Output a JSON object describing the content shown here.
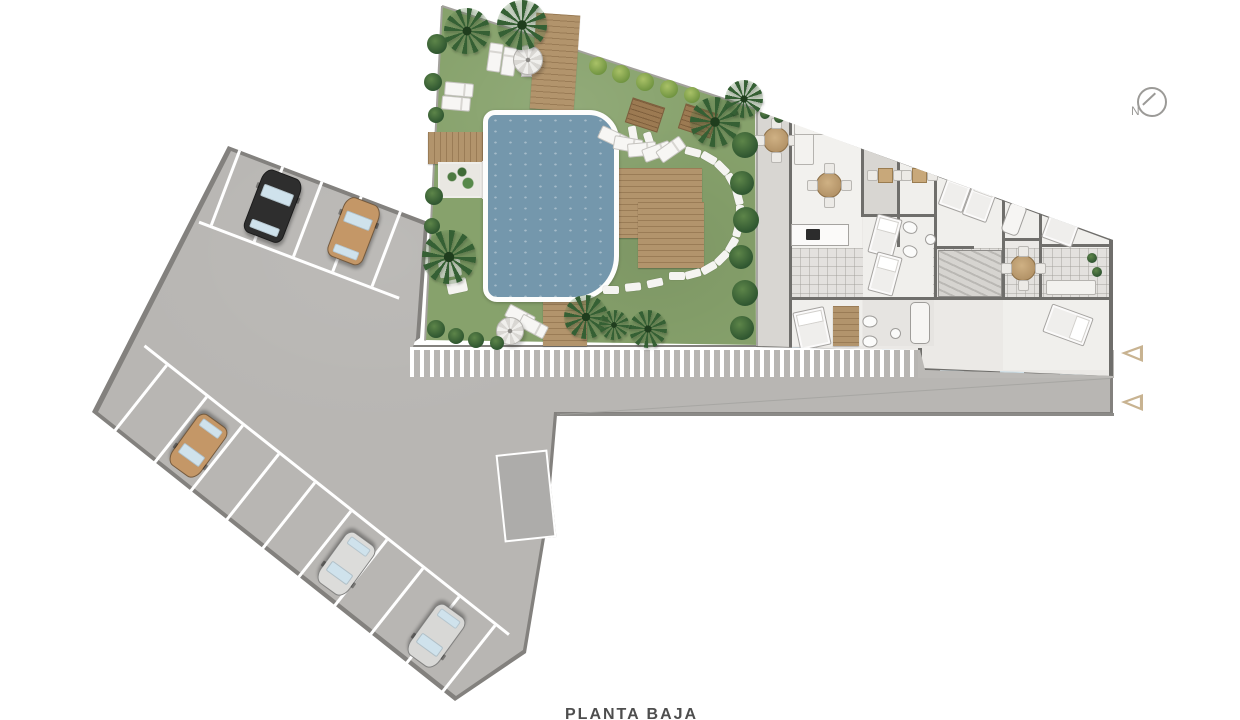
{
  "meta": {
    "caption": "PLANTA BAJA",
    "north_label": "N"
  },
  "colors": {
    "lot": "#b8b6b3",
    "lot_edge": "#83817e",
    "grass": "#87a26c",
    "pool": "#7497ac",
    "wood": "#b2946c",
    "wall": "#6f6e6b",
    "arrow_outline": "#c8b391",
    "car_black": "#2e2e2e",
    "car_tan": "#c49767",
    "car_silver": "#dcdcda"
  },
  "lot": {
    "outer": [
      [
        228,
        146
      ],
      [
        428,
        222
      ],
      [
        420,
        338
      ],
      [
        410,
        345
      ],
      [
        1113,
        345
      ],
      [
        1113,
        415
      ],
      [
        557,
        415
      ],
      [
        548,
        520
      ],
      [
        526,
        653
      ],
      [
        455,
        701
      ],
      [
        92,
        412
      ]
    ],
    "inner": [
      [
        231,
        151
      ],
      [
        424,
        225
      ],
      [
        416,
        338
      ],
      [
        413,
        347
      ],
      [
        1110,
        347
      ],
      [
        1110,
        412
      ],
      [
        554,
        412
      ],
      [
        545,
        519
      ],
      [
        523,
        650
      ],
      [
        456,
        696
      ],
      [
        98,
        412
      ]
    ]
  },
  "stall_rows": [
    {
      "x": 228,
      "y": 146,
      "w": 214,
      "h": 80,
      "rot": 20.8,
      "origin": "0px 0px",
      "period": 42,
      "offset": 18,
      "aisle": "bottom"
    },
    {
      "x": 92,
      "y": 326,
      "w": 465,
      "h": 86,
      "rot": 38.4,
      "origin": "0px 86px",
      "period": 46,
      "offset": 36,
      "aisle": "top"
    }
  ],
  "ramp": {
    "x": 500,
    "y": 452,
    "w": 48,
    "h": 84,
    "rot": -6
  },
  "cars": [
    {
      "color": "#2e2e2e",
      "x": 252,
      "y": 172,
      "w": 40,
      "h": 66,
      "rot": 21
    },
    {
      "color": "#c49767",
      "x": 335,
      "y": 199,
      "w": 36,
      "h": 62,
      "rot": 21
    },
    {
      "color": "#c49767",
      "x": 180,
      "y": 415,
      "w": 34,
      "h": 60,
      "rot": 216
    },
    {
      "color": "#dcdcda",
      "x": 328,
      "y": 533,
      "w": 34,
      "h": 60,
      "rot": 216
    },
    {
      "color": "#d8d8d6",
      "x": 418,
      "y": 605,
      "w": 34,
      "h": 60,
      "rot": 216
    }
  ],
  "road": {
    "edge": {
      "x": 557,
      "y": 413,
      "w": 557,
      "h": 3
    },
    "joint": {
      "x": 560,
      "y": 414,
      "len": 552,
      "rot": -3.75
    }
  },
  "crosswalk": {
    "x": 410,
    "y": 347,
    "w": 508,
    "h": 27
  },
  "sidewalk": {
    "x": 918,
    "y": 347,
    "w": 196,
    "h": 28
  },
  "garden": {
    "x": 425,
    "y": 4,
    "w": 336,
    "h": 344,
    "clip": [
      [
        17,
        2
      ],
      [
        334,
        106
      ],
      [
        334,
        341
      ],
      [
        0,
        336
      ]
    ],
    "edge_top": {
      "x": 442,
      "y": 5,
      "len": 333,
      "rot": 18.2
    },
    "edge_left": {
      "x": 441,
      "y": 6,
      "len": 335,
      "rot": 2.9
    },
    "decks": [
      {
        "x": 533,
        "y": 14,
        "w": 44,
        "h": 96,
        "rot": 4,
        "dir": "h"
      },
      {
        "x": 428,
        "y": 132,
        "w": 98,
        "h": 32,
        "rot": 0,
        "dir": "v"
      },
      {
        "x": 618,
        "y": 168,
        "w": 84,
        "h": 70,
        "rot": 0,
        "dir": "h"
      },
      {
        "x": 638,
        "y": 202,
        "w": 66,
        "h": 66,
        "rot": 0,
        "dir": "h"
      },
      {
        "x": 543,
        "y": 286,
        "w": 44,
        "h": 60,
        "rot": 0,
        "dir": "h"
      }
    ],
    "benches": [
      {
        "x": 628,
        "y": 102,
        "w": 32,
        "h": 24,
        "rot": 18
      },
      {
        "x": 681,
        "y": 108,
        "w": 32,
        "h": 24,
        "rot": 18
      }
    ],
    "planters": [
      {
        "x": 438,
        "y": 162,
        "w": 40,
        "h": 32,
        "kind": "g"
      },
      {
        "x": 482,
        "y": 161,
        "w": 24,
        "h": 34,
        "kind": "r"
      }
    ],
    "pool": {
      "x": 483,
      "y": 110,
      "w": 126,
      "h": 182,
      "radius": "12px 30px 46px 14px"
    },
    "parasols": [
      {
        "x": 513,
        "y": 45,
        "d": 28
      },
      {
        "x": 496,
        "y": 317,
        "d": 26
      }
    ],
    "loungers": [
      [
        494,
        56,
        8
      ],
      [
        508,
        60,
        8
      ],
      [
        458,
        88,
        95
      ],
      [
        455,
        102,
        95
      ],
      [
        612,
        136,
        115
      ],
      [
        627,
        143,
        100
      ],
      [
        641,
        148,
        85
      ],
      [
        656,
        150,
        70
      ],
      [
        670,
        148,
        55
      ],
      [
        519,
        315,
        118
      ],
      [
        532,
        325,
        118
      ]
    ],
    "side_tables": [
      [
        521,
        66
      ]
    ],
    "stones": [
      [
        633,
        134,
        80
      ],
      [
        649,
        140,
        72
      ],
      [
        693,
        152,
        15
      ],
      [
        709,
        158,
        30
      ],
      [
        722,
        168,
        45
      ],
      [
        732,
        181,
        60
      ],
      [
        738,
        197,
        75
      ],
      [
        740,
        213,
        90
      ],
      [
        738,
        229,
        105
      ],
      [
        732,
        245,
        120
      ],
      [
        722,
        258,
        135
      ],
      [
        709,
        268,
        150
      ],
      [
        693,
        274,
        165
      ],
      [
        677,
        276,
        0
      ],
      [
        655,
        283,
        168
      ],
      [
        633,
        287,
        174
      ],
      [
        611,
        290,
        0
      ]
    ],
    "pads": [
      [
        450,
        268,
        22,
        17,
        -8
      ],
      [
        457,
        286,
        20,
        14,
        -12
      ]
    ],
    "palms": [
      [
        467,
        31,
        46
      ],
      [
        522,
        25,
        50
      ],
      [
        449,
        257,
        54
      ],
      [
        715,
        122,
        50
      ],
      [
        744,
        99,
        38
      ],
      [
        586,
        317,
        44
      ],
      [
        648,
        329,
        38
      ],
      [
        614,
        325,
        30
      ]
    ],
    "bushes_dark": [
      [
        745,
        145,
        26
      ],
      [
        742,
        183,
        24
      ],
      [
        746,
        220,
        26
      ],
      [
        741,
        257,
        24
      ],
      [
        745,
        293,
        26
      ],
      [
        742,
        328,
        24
      ],
      [
        437,
        44,
        20
      ],
      [
        433,
        82,
        18
      ],
      [
        436,
        115,
        16
      ],
      [
        434,
        196,
        18
      ],
      [
        432,
        226,
        16
      ],
      [
        436,
        329,
        18
      ],
      [
        456,
        336,
        16
      ],
      [
        476,
        340,
        16
      ],
      [
        497,
        343,
        14
      ]
    ],
    "bushes_light": [
      [
        598,
        66,
        18
      ],
      [
        621,
        74,
        18
      ],
      [
        645,
        82,
        18
      ],
      [
        669,
        89,
        18
      ],
      [
        692,
        95,
        16
      ]
    ]
  },
  "building": {
    "x": 755,
    "y": 106,
    "w": 362,
    "h": 276,
    "clip": [
      [
        0,
        4
      ],
      [
        358,
        134
      ],
      [
        358,
        270
      ],
      [
        170,
        264
      ],
      [
        165,
        244
      ],
      [
        1,
        241
      ]
    ],
    "rooms": [
      [
        757,
        110,
        33,
        238,
        "r-ter"
      ],
      [
        791,
        113,
        71,
        135,
        "r-liv"
      ],
      [
        863,
        122,
        35,
        92,
        "r-ter"
      ],
      [
        899,
        132,
        36,
        114,
        "r-rm"
      ],
      [
        936,
        145,
        67,
        103,
        "r-rm"
      ],
      [
        1003,
        168,
        37,
        72,
        "r-rm"
      ],
      [
        1041,
        182,
        69,
        116,
        "r-rm"
      ],
      [
        791,
        248,
        322,
        50,
        "r-cor"
      ],
      [
        863,
        217,
        70,
        80,
        "r-rm"
      ],
      [
        791,
        300,
        71,
        46,
        "r-rm"
      ],
      [
        863,
        300,
        71,
        46,
        "r-rm2"
      ],
      [
        1003,
        300,
        108,
        70,
        "r-rm"
      ],
      [
        936,
        250,
        66,
        47,
        "r-rm2"
      ]
    ],
    "walls": [
      [
        755,
        104,
        382,
        5,
        20.3,
        "0px 50%"
      ],
      [
        756,
        346,
        166,
        4,
        1.7,
        "0px 50%"
      ],
      [
        918,
        348,
        4,
        24,
        0,
        ""
      ],
      [
        920,
        368,
        195,
        4,
        2.4,
        "0px 50%"
      ],
      [
        1109,
        238,
        5,
        142,
        0,
        ""
      ],
      [
        789,
        112,
        3,
        236,
        0,
        ""
      ],
      [
        861,
        119,
        3,
        97,
        0,
        ""
      ],
      [
        897,
        129,
        3,
        118,
        0,
        ""
      ],
      [
        934,
        141,
        3,
        159,
        0,
        ""
      ],
      [
        1002,
        166,
        3,
        133,
        0,
        ""
      ],
      [
        1039,
        179,
        3,
        121,
        0,
        ""
      ],
      [
        861,
        214,
        75,
        3,
        0,
        ""
      ],
      [
        789,
        297,
        324,
        3,
        0,
        ""
      ],
      [
        1039,
        244,
        73,
        3,
        0,
        ""
      ],
      [
        1002,
        238,
        39,
        3,
        0,
        ""
      ],
      [
        934,
        246,
        40,
        3,
        0,
        ""
      ],
      [
        969,
        250,
        3,
        47,
        0,
        ""
      ]
    ],
    "light_walls": [
      [
        756,
        108,
        2,
        240
      ]
    ],
    "windows": [
      [
        800,
        122,
        30,
        3,
        20.3
      ],
      [
        880,
        151,
        30,
        3,
        20.3
      ],
      [
        960,
        181,
        30,
        3,
        20.3
      ],
      [
        1050,
        214,
        30,
        3,
        20.3
      ],
      [
        792,
        347,
        24,
        3,
        1.7
      ],
      [
        852,
        349,
        24,
        3,
        1.7
      ],
      [
        882,
        349,
        24,
        3,
        1.7
      ],
      [
        940,
        370,
        24,
        3,
        2.4
      ],
      [
        1000,
        371,
        24,
        3,
        2.4
      ],
      [
        1060,
        374,
        24,
        3,
        2.4
      ]
    ],
    "stairs": {
      "x": 938,
      "y": 250,
      "w": 62,
      "h": 45
    },
    "tables4": [
      [
        775,
        139
      ],
      [
        828,
        184
      ],
      [
        1022,
        267
      ]
    ],
    "tables2": [
      [
        884,
        174
      ],
      [
        918,
        174
      ]
    ],
    "sofas": [
      [
        794,
        117,
        18,
        46
      ],
      [
        794,
        117,
        36,
        16
      ],
      [
        1046,
        280,
        48,
        13
      ]
    ],
    "counters": [
      [
        791,
        224,
        56,
        20
      ],
      [
        1004,
        180,
        34,
        12
      ]
    ],
    "cooktops": [
      [
        806,
        229,
        14,
        11
      ]
    ],
    "beds": [
      [
        944,
        168,
        24,
        40,
        20
      ],
      [
        968,
        178,
        24,
        40,
        20
      ],
      [
        1048,
        198,
        30,
        44,
        20
      ],
      [
        1053,
        303,
        28,
        42,
        110
      ],
      [
        796,
        309,
        30,
        37,
        -12
      ],
      [
        872,
        216,
        24,
        38,
        15
      ],
      [
        872,
        254,
        24,
        38,
        15
      ]
    ],
    "wood_bars": [
      [
        938,
        160,
        54,
        8,
        20
      ],
      [
        1042,
        192,
        42,
        8,
        20
      ],
      [
        928,
        140,
        62,
        12,
        20.3
      ],
      [
        1032,
        178,
        62,
        12,
        20.3
      ],
      [
        833,
        306,
        26,
        40,
        0
      ]
    ],
    "toilets": [
      [
        904,
        220,
        -70
      ],
      [
        904,
        244,
        -70
      ],
      [
        1010,
        188,
        20
      ],
      [
        864,
        314,
        90
      ],
      [
        864,
        334,
        90
      ]
    ],
    "sinks": [
      [
        925,
        234
      ],
      [
        1026,
        180
      ],
      [
        890,
        328
      ],
      [
        1030,
        183
      ]
    ],
    "tubs": [
      [
        910,
        302,
        18,
        40,
        0
      ],
      [
        1005,
        203,
        16,
        30,
        20
      ]
    ],
    "plants": [
      [
        866,
        131
      ],
      [
        890,
        148
      ],
      [
        1092,
        258
      ],
      [
        1097,
        272
      ],
      [
        838,
        107
      ],
      [
        930,
        137
      ],
      [
        1024,
        171
      ],
      [
        765,
        114
      ],
      [
        779,
        118
      ]
    ]
  },
  "north": {
    "cx": 1150,
    "cy": 100,
    "r": 13
  },
  "triangles": [
    [
      [
        1143,
        345
      ],
      [
        1143,
        362
      ],
      [
        1121,
        353
      ]
    ],
    [
      [
        1143,
        394
      ],
      [
        1143,
        411
      ],
      [
        1121,
        402
      ]
    ]
  ],
  "caption_pos": {
    "x": 565,
    "y": 706
  },
  "north_label_pos": {
    "x": 1131,
    "y": 106
  }
}
